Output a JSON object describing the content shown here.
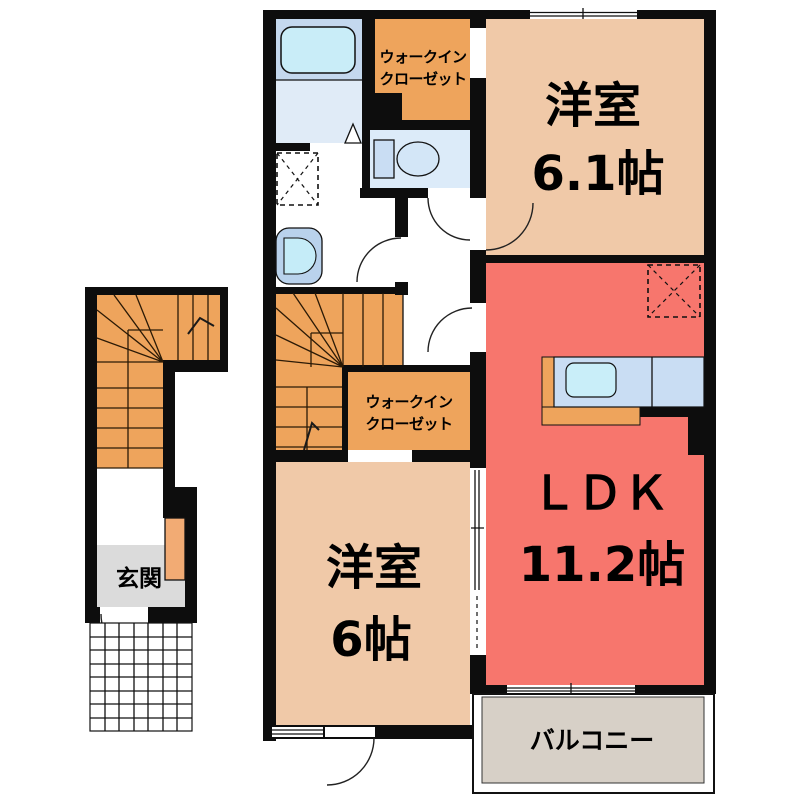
{
  "plan": {
    "unit": {
      "bedroom1": {
        "name": "洋室",
        "size": "6.1帖"
      },
      "ldk": {
        "name": "ＬＤＫ",
        "size": "11.2帖"
      },
      "bedroom2": {
        "name": "洋室",
        "size": "6帖"
      },
      "wic_upper": {
        "line1": "ウォークイン",
        "line2": "クローゼット"
      },
      "wic_lower": {
        "line1": "ウォークイン",
        "line2": "クローゼット"
      },
      "balcony": {
        "label": "バルコニー"
      }
    },
    "ground": {
      "entrance": {
        "label": "玄関"
      }
    },
    "colors": {
      "wall": "#0d0d0d",
      "bedroom": "#f0c9a8",
      "ldk": "#f7766d",
      "accent_orange": "#eea45c",
      "balcony": "#d7d0c7",
      "entrance_floor": "#dbdbdb",
      "bath_upper": "#c4d8ee",
      "bath_lower": "#e0ebf7",
      "bathtub": "#c9edf8",
      "toilet_floor": "#dcebf9",
      "fixture_blue": "#c9ddf3",
      "kitchen_sink": "#c9eef9",
      "basin_outer": "#b9d2ec",
      "basin_inner": "#c5ecf8",
      "shoe_cabinet": "#f2ab74"
    }
  }
}
